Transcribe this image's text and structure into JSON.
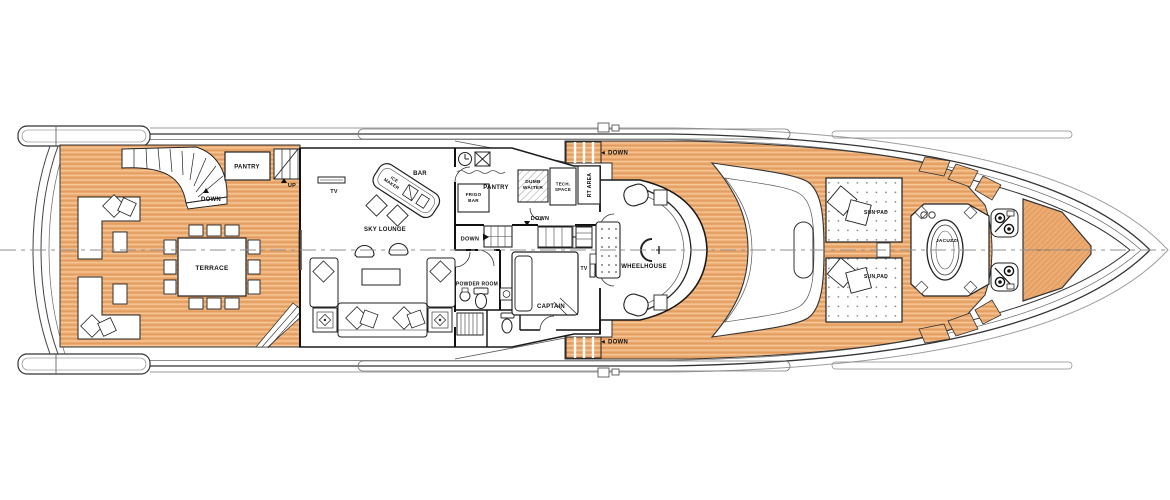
{
  "type": "yacht-deck-general-arrangement-plan",
  "colors": {
    "teak": "#ECAB72",
    "teak_light": "#F6CA9B",
    "teak_dark": "#DE9858",
    "outline": "#2b2b2b",
    "centerline": "#8f8f8f"
  },
  "labels": {
    "terrace": "TERRACE",
    "pantry_aft": "PANTRY",
    "down_aft": "DOWN",
    "up_aft": "UP",
    "tv_skylounge": "TV",
    "bar": "BAR",
    "ice_maker_l1": "ICE",
    "ice_maker_l2": "MAKER",
    "frigo_l1": "FRIGO",
    "frigo_l2": "BAR",
    "sky_lounge": "SKY LOUNGE",
    "pantry_main": "PANTRY",
    "dumb_waiter_l1": "DUMB",
    "dumb_waiter_l2": "WAITER",
    "tech_space_l1": "TECH.",
    "tech_space_l2": "SPACE",
    "rt_area": "RT AREA",
    "down_service": "DOWN",
    "down_lift": "DOWN",
    "powder_room": "POWDER ROOM",
    "captain": "CAPTAIN",
    "tv_captain": "TV",
    "wheelhouse": "WHEELHOUSE",
    "down_walkway_port": "◄ DOWN",
    "down_walkway_starboard": "◄ DOWN",
    "sun_pad_top": "SUN PAD",
    "sun_pad_bottom": "SUN PAD",
    "jacuzzi": "JACUZZI"
  }
}
